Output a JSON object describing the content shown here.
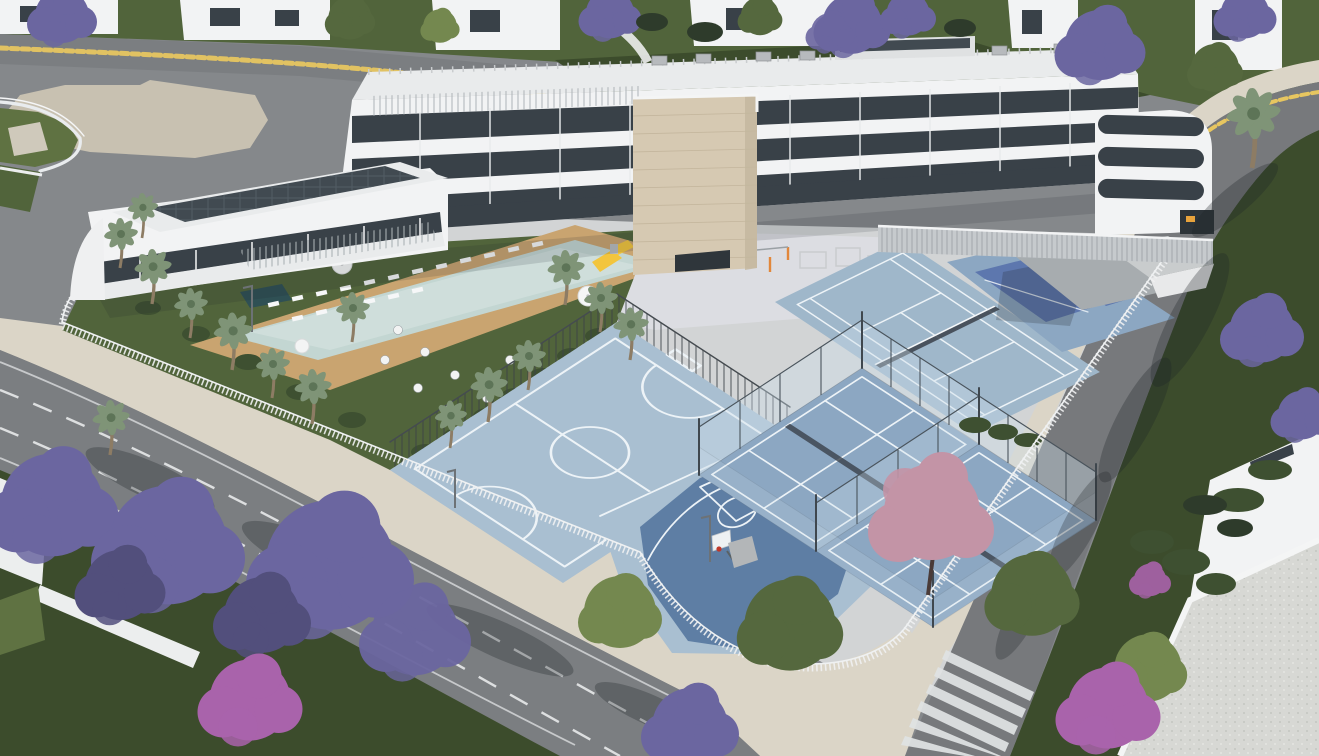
{
  "scene": {
    "description": "Aerial 3D architectural render of a modern white apartment complex with a stone tower, landscaped pool garden with palm trees, multi-sport court, basketball half court, glass-walled padel courts, tennis court, playground, white perimeter fence and tree-lined streets with jacarandas and a zebra crossing",
    "elements": [
      "apartment building",
      "stone central tower",
      "rounded corner wing",
      "annex building with solar roof",
      "entrance plaza",
      "roundabout lawn with curved fence",
      "swimming pool",
      "spa plunge pool",
      "wooden pool deck",
      "sun loungers",
      "white parasols",
      "garden terrace with tables",
      "multi-sport court",
      "basketball half court with hoop",
      "padel courts with glass walls",
      "tennis court with net",
      "blue courts with shade canopy",
      "children playground with yellow slide",
      "calisthenics bars",
      "white perimeter fence",
      "dark court fencing",
      "street with dashed lane lines",
      "street with zebra crossing",
      "jacaranda trees",
      "bougainvillea bushes",
      "palm trees",
      "neighbouring white villas",
      "gravel villa roof",
      "street lamps",
      "tree shadows on asphalt"
    ],
    "counts": {
      "palm_trees": 16,
      "caged_padel_courts": 2,
      "tennis_courts": 1,
      "crosswalk_stripes": 6,
      "sun_loungers": 18
    }
  },
  "colors": {
    "asphalt": "#85888b",
    "road": "#7b7e81",
    "road_right": "#77797c",
    "concrete": "#d2d4d5",
    "plaza": "#c8c1b1",
    "sidewalk": "#dbd5c7",
    "lawn": "#51643b",
    "lawn_dark": "#3c4c2c",
    "lawn_bright": "#5f7242",
    "court_base": "#a9bfd1",
    "court_dark": "#5e7ea4",
    "padel": "#8ca7c2",
    "padel_blue": "#5d77ae",
    "tennis": "#9fb7ca",
    "line_white": "#edf3f7",
    "glass": "#cfe0ec",
    "net_dark": "#39414a",
    "fence_white": "#eff1f2",
    "pool_water": "#c3d6d2",
    "pool_light": "#d9e6e2",
    "deck_wood": "#c9a470",
    "spa": "#2f5054",
    "building_white": "#f2f3f4",
    "building_shade": "#dfe2e3",
    "window_dark": "#394148",
    "stone": "#d6c9b2",
    "roof": "#e9ebec",
    "solar": "#414a51",
    "canopy": "#a7acaf",
    "louver": "#c6cacd",
    "yellow_line": "#e7c660",
    "crosswalk": "#e0e3e4",
    "jacaranda": "#6b66a0",
    "jacaranda_deep": "#524f7c",
    "bougainvillea": "#a963ab",
    "pink_tree": "#c394a6",
    "tree_green": "#55683e",
    "tree_light": "#74884f",
    "palm": "#7f9477",
    "palm_dark": "#2e3b2b",
    "trunk": "#8d7c64",
    "shadow": "#1f2428",
    "hoop_red": "#c0392b",
    "play_yellow": "#f2c53d",
    "play_orange": "#e2873b",
    "glow": "#e8a33c",
    "gravel": "#d7d8d4",
    "bush": "#3e5031"
  }
}
